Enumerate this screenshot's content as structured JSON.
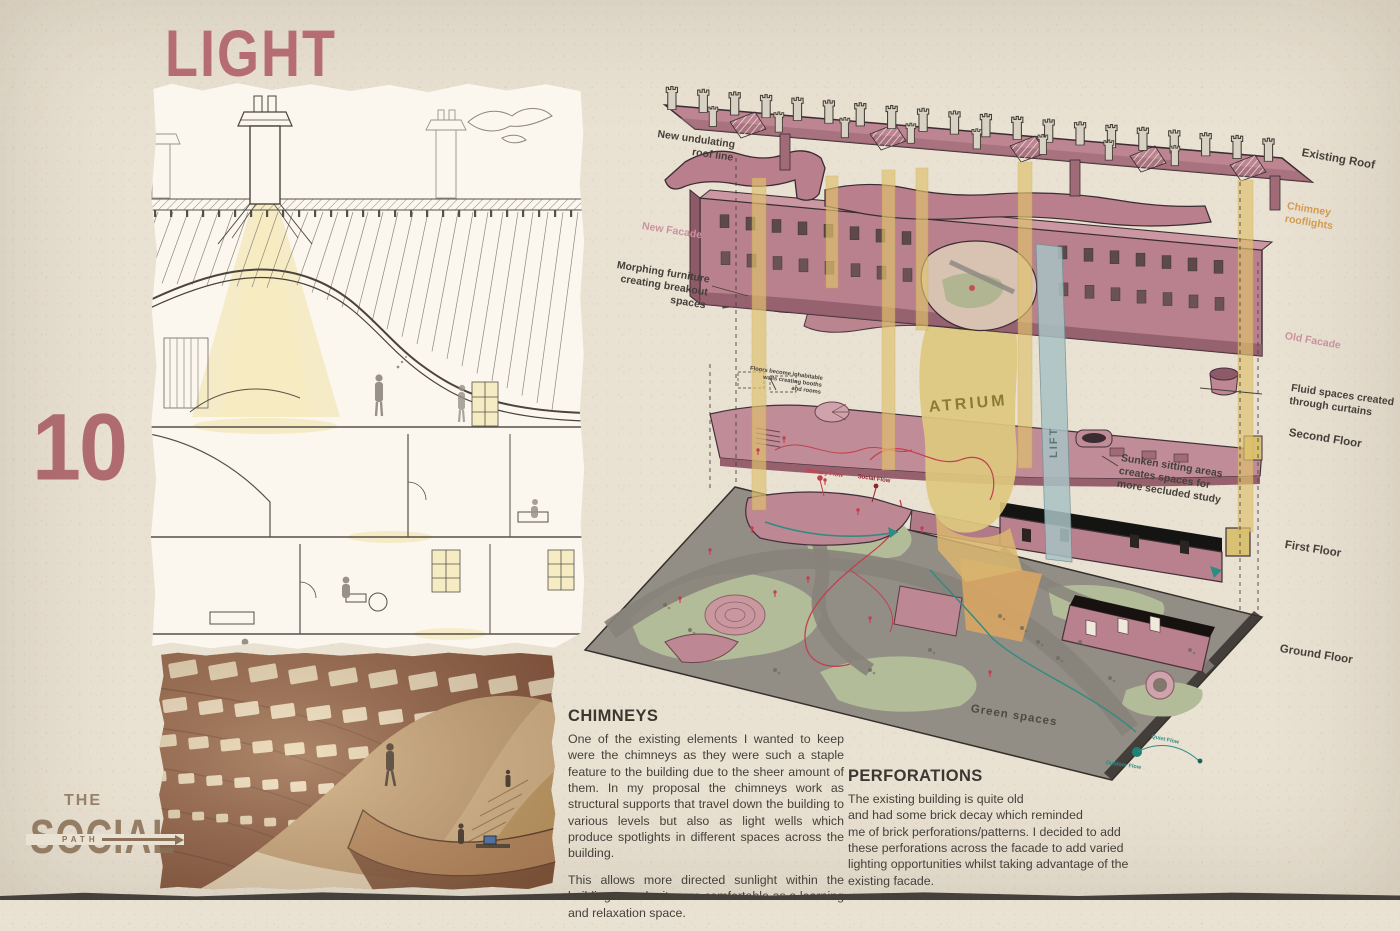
{
  "page": {
    "title": "LIGHT",
    "number": "10"
  },
  "logo": {
    "the": "THE",
    "social": "SOCIAL",
    "path": "PATH"
  },
  "diagram": {
    "labels": {
      "new_roof": "New undulating\nroof line",
      "existing_roof": "Existing Roof",
      "chimney_rooflights": "Chimney\nrooflights",
      "new_facade": "New Facade",
      "morphing": "Morphing furniture\ncreating breakout\nspaces",
      "old_facade": "Old Facade",
      "fluid_spaces": "Fluid spaces created\nthrough curtains",
      "second_floor": "Second Floor",
      "hoarding": "Floors become inhabitable\nwalls creating booths\nand rooms",
      "sunken": "Sunken sitting areas\ncreates spaces for\nmore secluded study",
      "first_floor": "First Floor",
      "ground_floor": "Ground Floor",
      "green_spaces": "Green spaces",
      "atrium": "ATRIUM",
      "lift": "LIFT",
      "primary_flow": "Primary Flow",
      "social_flow": "Social Flow",
      "quiet_flow": "Quiet Flow",
      "outdoor_flow": "Outdoor Flow"
    }
  },
  "text_blocks": {
    "chimneys": {
      "heading": "CHIMNEYS",
      "body1": "One of the existing elements I wanted to keep were the chimneys as they were such a staple feature to the building due to the sheer amount of them. In my proposal the chimneys work as structural supports that travel down the building to various levels but also as light wells which produce spotlights in different spaces across the building.",
      "body2": "This allows more directed sunlight within the building to make it more comfortable as a learning and relaxation space."
    },
    "perforations": {
      "heading": "PERFORATIONS",
      "body": "The existing building is quite old\nand had some brick decay which reminded\nme of brick perforations/patterns. I decided to add these perforations across the facade to add varied lighting opportunities whilst taking advantage of the existing facade."
    }
  },
  "colors": {
    "paper": "#e9e1d2",
    "accent_rose": "#b2636c",
    "roof_pink": "#bd8591",
    "light_yellow": "#e0c26e",
    "atrium_text": "#8a7c33",
    "lift_blue": "#a9c2c4",
    "green": "#b2bc98",
    "path_grey": "#8b8781",
    "ink": "#4a443c",
    "label_pink": "#c9939d",
    "label_orange": "#d49a4f",
    "flow_red": "#c2404e",
    "flow_teal": "#2f8c82"
  }
}
